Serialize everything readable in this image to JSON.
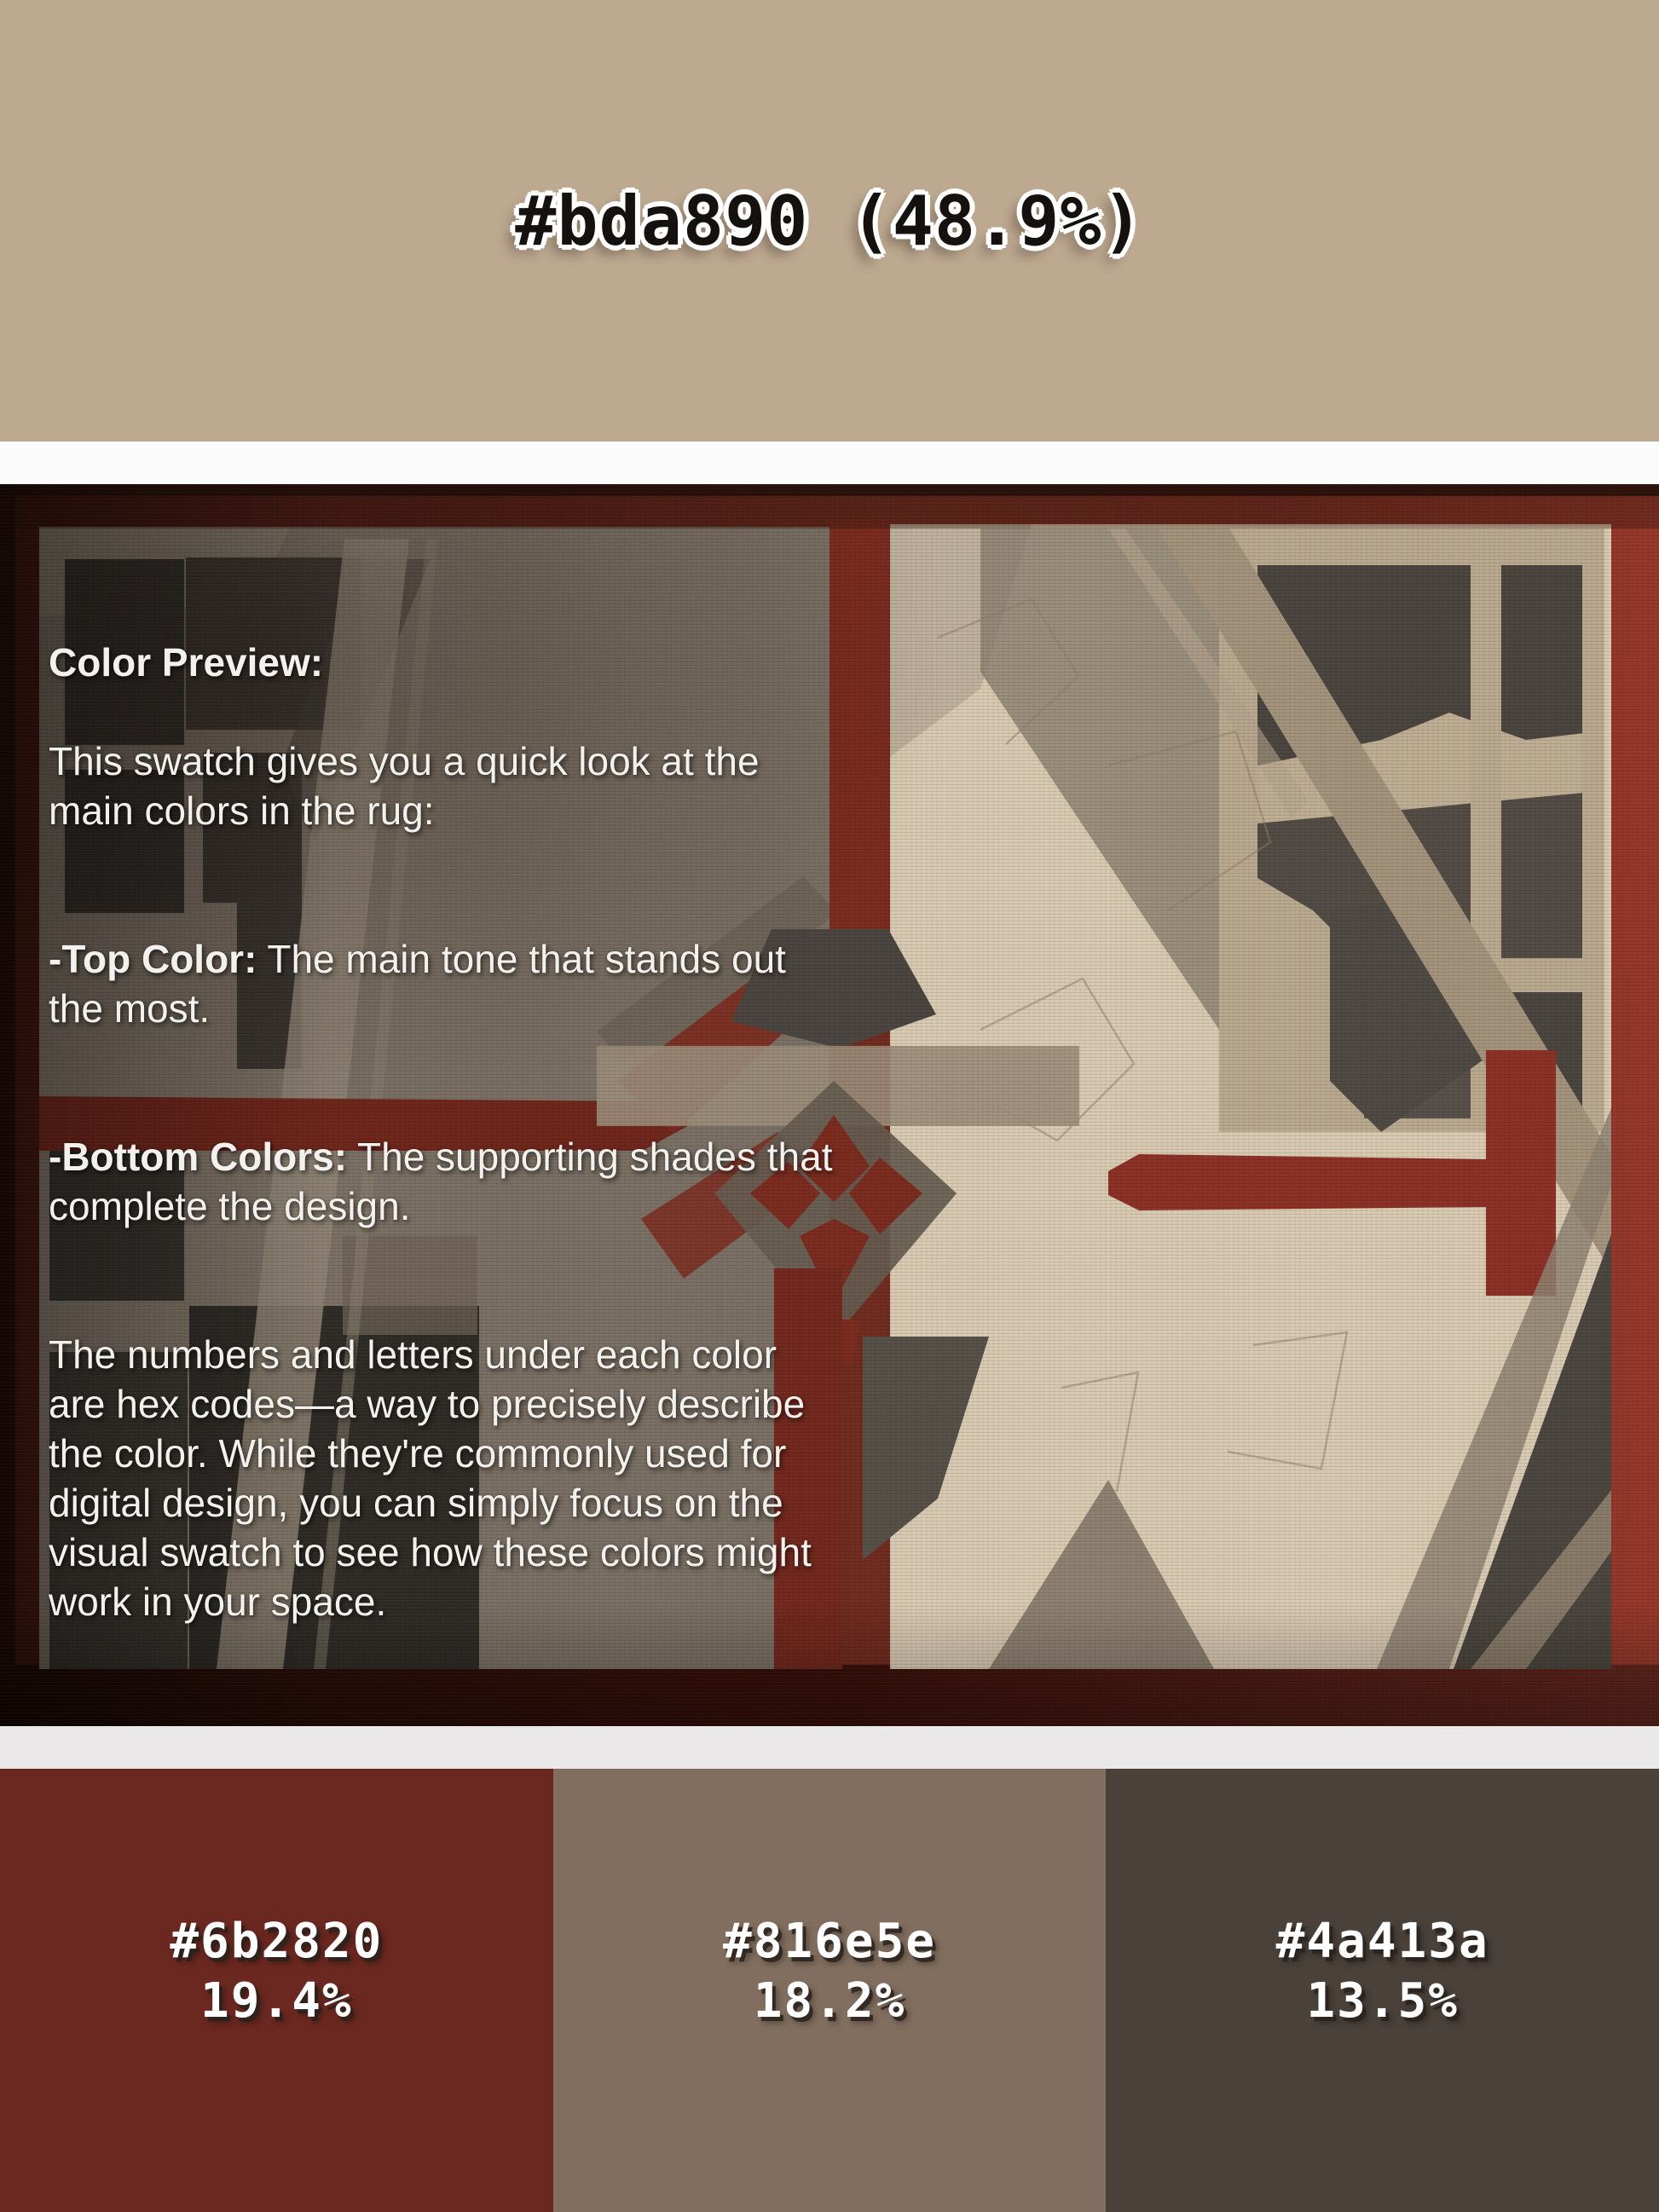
{
  "title": {
    "text": "#bda890 (48.9%)",
    "hex": "#bda890",
    "percent": "48.9%"
  },
  "colors": {
    "top_swatch": "#bda890",
    "strip_top": "#fcfbfb",
    "strip_bottom": "#eae8e9",
    "rug_border_red": "#6e2a1e",
    "rug_field_left": "#7b7064",
    "rug_field_cream": "#d9cab2",
    "rug_accent_red": "#7c2b1f",
    "rug_dark_block": "#3a3631",
    "overlay_text": "#f3f1ed"
  },
  "overlay": {
    "heading": "Color Preview:",
    "intro": "This swatch gives you a quick look at the\nmain colors in the rug:",
    "top_color_label": "-Top Color:",
    "top_color_text": " The main tone that stands out\nthe most.",
    "bottom_colors_label": "-Bottom Colors:",
    "bottom_colors_text": " The supporting shades that\ncomplete the design.",
    "hex_explainer": "The numbers and letters under each color\nare hex codes—a way to precisely describe\nthe color. While they're commonly used for\ndigital design, you can simply focus on the\nvisual swatch to see how these colors might\nwork in your space.",
    "disclaimer": "Colors may look slightly different on fabric\ndue to lighting and material, so use this as a\nguide to get a better idea of how the rug's\ncolors might work in your space."
  },
  "swatches": [
    {
      "hex": "#6b2820",
      "percent": "19.4%",
      "color": "#6b2820"
    },
    {
      "hex": "#816e5e",
      "percent": "18.2%",
      "color": "#816e5e"
    },
    {
      "hex": "#4a413a",
      "percent": "13.5%",
      "color": "#4a413a"
    }
  ]
}
